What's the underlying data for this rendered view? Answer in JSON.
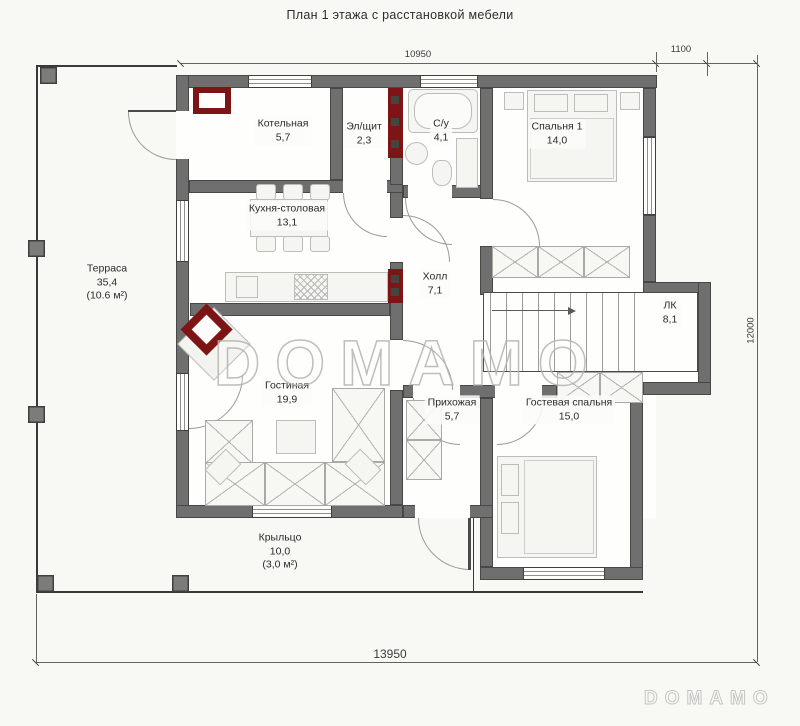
{
  "title": "План 1 этажа с расстановкой мебели",
  "watermark": {
    "center": "DOMAMO",
    "corner": "DOMAMO"
  },
  "dimensions": {
    "top": "10950",
    "top_right": "1100",
    "right": "12000",
    "bottom": "13950"
  },
  "rooms": [
    {
      "name": "Котельная",
      "area": "5,7"
    },
    {
      "name": "Эл/щит",
      "area": "2,3"
    },
    {
      "name": "С/у",
      "area": "4,1"
    },
    {
      "name": "Спальня 1",
      "area": "14,0"
    },
    {
      "name": "Кухня-столовая",
      "area": "13,1"
    },
    {
      "name": "Терраса",
      "area": "35,4",
      "note": "(10.6 м²)"
    },
    {
      "name": "Холл",
      "area": "7,1"
    },
    {
      "name": "ЛК",
      "area": "8,1"
    },
    {
      "name": "Гостиная",
      "area": "19,9"
    },
    {
      "name": "Прихожая",
      "area": "5,7"
    },
    {
      "name": "Гостевая спальня",
      "area": "15,0"
    },
    {
      "name": "Крыльцо",
      "area": "10,0",
      "note": "(3,0 м²)"
    }
  ],
  "colors": {
    "wall": "#6f6f6f",
    "accent_red": "#7d1416",
    "watermark_outline": "#b3b3b0"
  }
}
